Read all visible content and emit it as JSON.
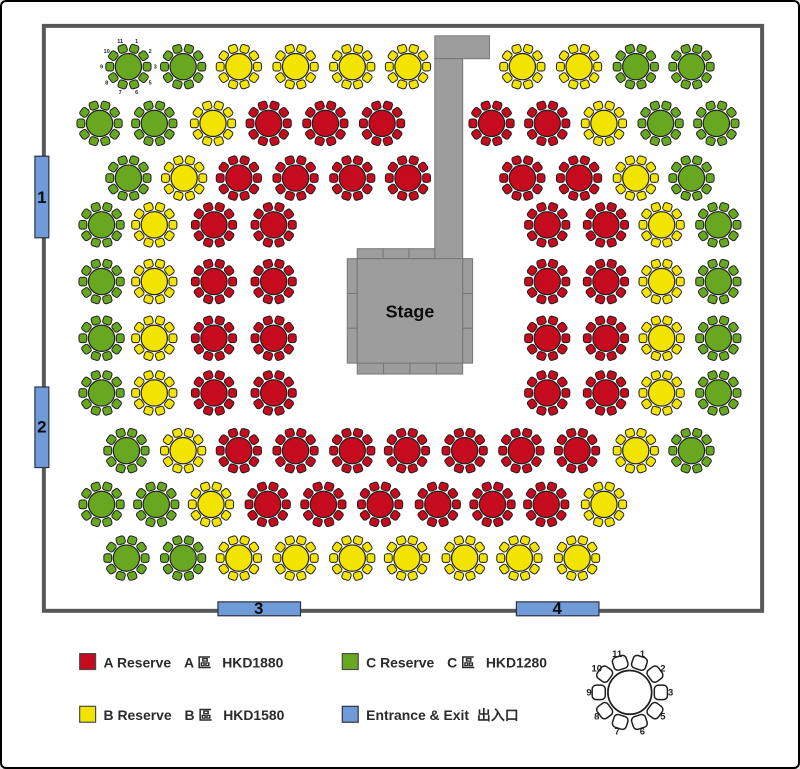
{
  "colors": {
    "zone_a": "#c60b1e",
    "zone_b": "#f3e400",
    "zone_c": "#68a821",
    "entrance_blue": "#6f9bd8",
    "stage_gray": "#9d9d9d",
    "wall_gray": "#58585a",
    "table_outline": "#1e1e1e"
  },
  "stage": {
    "label": "Stage"
  },
  "entrances": [
    {
      "label": "1"
    },
    {
      "label": "2"
    },
    {
      "label": "3"
    },
    {
      "label": "4"
    }
  ],
  "seat_numbers": [
    "1",
    "2",
    "3",
    "5",
    "6",
    "7",
    "8",
    "9",
    "10",
    "11"
  ],
  "legend": {
    "items": [
      {
        "name": "A Reserve",
        "zone": "A 區",
        "price": "HKD1880",
        "color": "#c60b1e"
      },
      {
        "name": "B Reserve",
        "zone": "B 區",
        "price": "HKD1580",
        "color": "#f3e400"
      },
      {
        "name": "C Reserve",
        "zone": "C 區",
        "price": "HKD1280",
        "color": "#68a821"
      },
      {
        "name": "Entrance & Exit",
        "zone": "出入口",
        "price": "",
        "color": "#6f9bd8"
      }
    ]
  },
  "floor": {
    "rows": [
      {
        "y": 65,
        "tables": [
          {
            "x": 127,
            "zone": "C",
            "numbered": true
          },
          {
            "x": 182,
            "zone": "C"
          },
          {
            "x": 238,
            "zone": "B"
          },
          {
            "x": 295,
            "zone": "B"
          },
          {
            "x": 352,
            "zone": "B"
          },
          {
            "x": 408,
            "zone": "B"
          },
          {
            "x": 523,
            "zone": "B"
          },
          {
            "x": 580,
            "zone": "B"
          },
          {
            "x": 637,
            "zone": "C"
          },
          {
            "x": 693,
            "zone": "C"
          }
        ]
      },
      {
        "y": 122,
        "tables": [
          {
            "x": 98,
            "zone": "C"
          },
          {
            "x": 153,
            "zone": "C"
          },
          {
            "x": 212,
            "zone": "B"
          },
          {
            "x": 268,
            "zone": "A"
          },
          {
            "x": 325,
            "zone": "A"
          },
          {
            "x": 382,
            "zone": "A"
          },
          {
            "x": 492,
            "zone": "A"
          },
          {
            "x": 548,
            "zone": "A"
          },
          {
            "x": 605,
            "zone": "B"
          },
          {
            "x": 662,
            "zone": "C"
          },
          {
            "x": 718,
            "zone": "C"
          }
        ]
      },
      {
        "y": 177,
        "tables": [
          {
            "x": 127,
            "zone": "C"
          },
          {
            "x": 183,
            "zone": "B"
          },
          {
            "x": 238,
            "zone": "A"
          },
          {
            "x": 295,
            "zone": "A"
          },
          {
            "x": 352,
            "zone": "A"
          },
          {
            "x": 408,
            "zone": "A"
          },
          {
            "x": 523,
            "zone": "A"
          },
          {
            "x": 580,
            "zone": "A"
          },
          {
            "x": 637,
            "zone": "B"
          },
          {
            "x": 693,
            "zone": "C"
          }
        ]
      },
      {
        "y": 224,
        "tables": [
          {
            "x": 100,
            "zone": "C"
          },
          {
            "x": 153,
            "zone": "B"
          },
          {
            "x": 213,
            "zone": "A"
          },
          {
            "x": 273,
            "zone": "A"
          },
          {
            "x": 548,
            "zone": "A"
          },
          {
            "x": 607,
            "zone": "A"
          },
          {
            "x": 663,
            "zone": "B"
          },
          {
            "x": 720,
            "zone": "C"
          }
        ]
      },
      {
        "y": 281,
        "tables": [
          {
            "x": 100,
            "zone": "C"
          },
          {
            "x": 153,
            "zone": "B"
          },
          {
            "x": 213,
            "zone": "A"
          },
          {
            "x": 273,
            "zone": "A"
          },
          {
            "x": 548,
            "zone": "A"
          },
          {
            "x": 607,
            "zone": "A"
          },
          {
            "x": 663,
            "zone": "B"
          },
          {
            "x": 720,
            "zone": "C"
          }
        ]
      },
      {
        "y": 338,
        "tables": [
          {
            "x": 100,
            "zone": "C"
          },
          {
            "x": 153,
            "zone": "B"
          },
          {
            "x": 213,
            "zone": "A"
          },
          {
            "x": 273,
            "zone": "A"
          },
          {
            "x": 548,
            "zone": "A"
          },
          {
            "x": 607,
            "zone": "A"
          },
          {
            "x": 663,
            "zone": "B"
          },
          {
            "x": 720,
            "zone": "C"
          }
        ]
      },
      {
        "y": 393,
        "tables": [
          {
            "x": 100,
            "zone": "C"
          },
          {
            "x": 153,
            "zone": "B"
          },
          {
            "x": 213,
            "zone": "A"
          },
          {
            "x": 273,
            "zone": "A"
          },
          {
            "x": 548,
            "zone": "A"
          },
          {
            "x": 607,
            "zone": "A"
          },
          {
            "x": 663,
            "zone": "B"
          },
          {
            "x": 720,
            "zone": "C"
          }
        ]
      },
      {
        "y": 451,
        "tables": [
          {
            "x": 125,
            "zone": "C"
          },
          {
            "x": 182,
            "zone": "B"
          },
          {
            "x": 238,
            "zone": "A"
          },
          {
            "x": 295,
            "zone": "A"
          },
          {
            "x": 352,
            "zone": "A"
          },
          {
            "x": 407,
            "zone": "A"
          },
          {
            "x": 465,
            "zone": "A"
          },
          {
            "x": 522,
            "zone": "A"
          },
          {
            "x": 578,
            "zone": "A"
          },
          {
            "x": 637,
            "zone": "B"
          },
          {
            "x": 693,
            "zone": "C"
          }
        ]
      },
      {
        "y": 505,
        "tables": [
          {
            "x": 100,
            "zone": "C"
          },
          {
            "x": 155,
            "zone": "C"
          },
          {
            "x": 210,
            "zone": "B"
          },
          {
            "x": 267,
            "zone": "A"
          },
          {
            "x": 323,
            "zone": "A"
          },
          {
            "x": 380,
            "zone": "A"
          },
          {
            "x": 438,
            "zone": "A"
          },
          {
            "x": 493,
            "zone": "A"
          },
          {
            "x": 547,
            "zone": "A"
          },
          {
            "x": 605,
            "zone": "B"
          }
        ]
      },
      {
        "y": 559,
        "tables": [
          {
            "x": 125,
            "zone": "C"
          },
          {
            "x": 182,
            "zone": "C"
          },
          {
            "x": 238,
            "zone": "B"
          },
          {
            "x": 295,
            "zone": "B"
          },
          {
            "x": 352,
            "zone": "B"
          },
          {
            "x": 407,
            "zone": "B"
          },
          {
            "x": 465,
            "zone": "B"
          },
          {
            "x": 520,
            "zone": "B"
          },
          {
            "x": 578,
            "zone": "B"
          }
        ]
      }
    ]
  }
}
